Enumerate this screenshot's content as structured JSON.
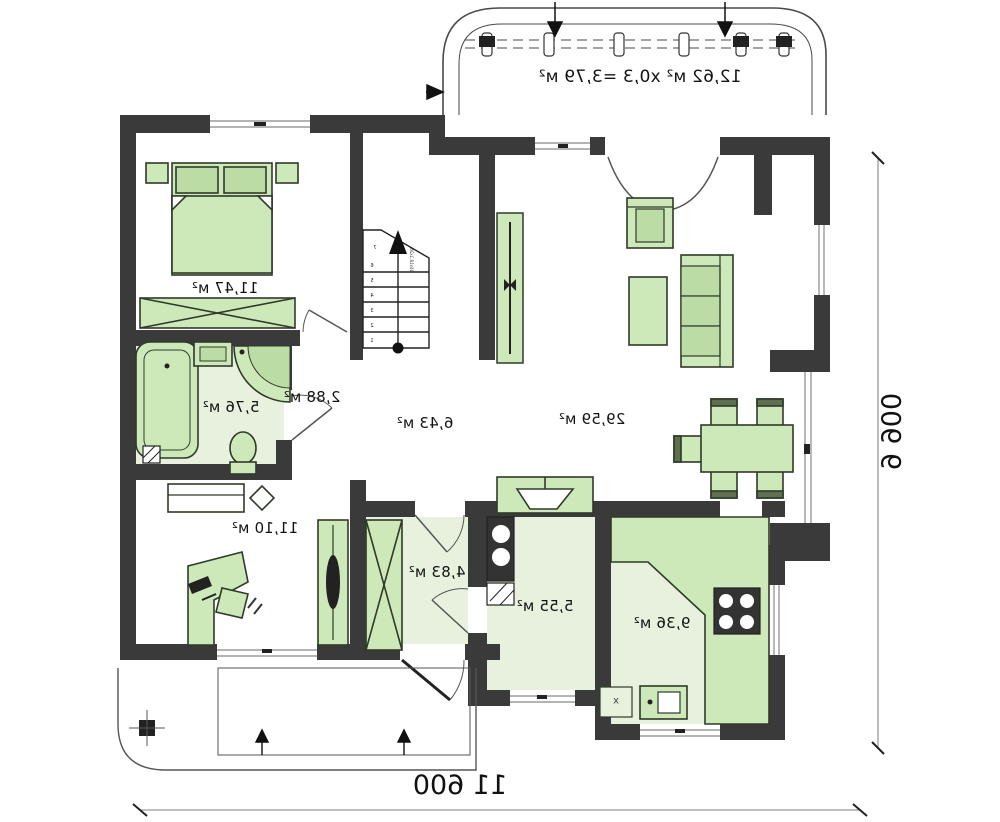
{
  "plan": {
    "terrace": {
      "area_label": "12,62 м² x0,3 =3,79 м²"
    },
    "rooms": {
      "bedroom": {
        "area": "11,47 м²"
      },
      "corridor": {
        "area": "2,88 м²"
      },
      "bathroom": {
        "area": "5,76 м²"
      },
      "office": {
        "area": "11,10 м²"
      },
      "hall": {
        "area": "6,43 м²"
      },
      "living": {
        "area": "29,59 м²"
      },
      "vestibule": {
        "area": "4,83 м²"
      },
      "utility": {
        "area": "5,55 м²"
      },
      "kitchen": {
        "area": "9,36 м²"
      }
    },
    "dimensions": {
      "width": "11 600",
      "height": "9 900"
    },
    "stairs": {
      "steps": [
        "1",
        "2",
        "3",
        "4",
        "5",
        "6",
        "7"
      ],
      "note": "16x18,1x26"
    },
    "marks": {
      "kitchen_drain": "x"
    },
    "colors": {
      "wall": "#3a3a3a",
      "furniture": "#cde8b9",
      "floor_tint": "#e7f1dd",
      "accent_dark": "#5f7050"
    }
  }
}
